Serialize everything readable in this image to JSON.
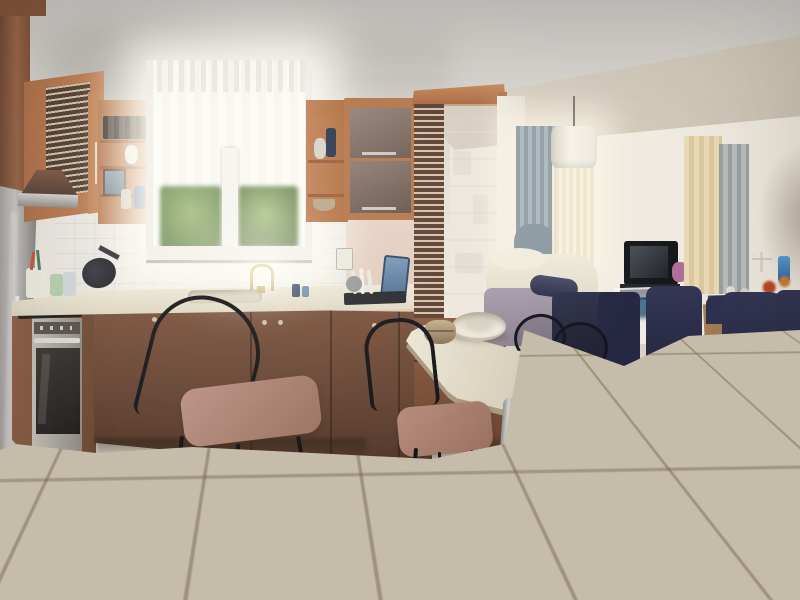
{
  "scene": {
    "domain": "natural-image",
    "description": "Panoramic daytime photo of an open-plan apartment: a kitchen with terracotta-orange cabinets, a bright curtained window and a tall glass display cabinet on the left; a small cream dining table with black metal chairs and mauve cushions in the center; a living room with a cream corner sofa, CRT television, glass coffee table, fireplace and a wooden dining table with navy upholstered chairs on the right; beige ceramic tile floor throughout.",
    "areas": [
      {
        "name": "kitchen",
        "position": "left"
      },
      {
        "name": "dining-area",
        "position": "center"
      },
      {
        "name": "living-room",
        "position": "right"
      }
    ]
  },
  "labels": {
    "stage": "Open-plan apartment interior photo",
    "ceiling": "Ceiling with diagonal soffit beam",
    "soffit": "Beige soffit beam across ceiling",
    "tall_cabinet": "Tall brown cabinet side panel",
    "fridge": "Stainless steel refrigerator",
    "upper_cabinets": "Terracotta upper cabinets with louvered door",
    "range_hood": "Copper range hood with steel rim",
    "open_shelf_left": "Open shelf unit with bottles, figurine and picture frame",
    "kitchen_window": "Kitchen window with white sheer curtain",
    "greenery": "Garden foliage seen through lower window panes",
    "open_shelf_right": "Open shelf column with bottle, figurine and bowl",
    "wall_cabinet": "Wall cabinet with two taupe lift-up doors",
    "glass_cabinet": "Tall glass-front display cabinet with glassware",
    "glassware": "Glassware on display shelves",
    "counter": "Cream laminate countertop",
    "sink": "Inset kitchen sink",
    "faucet": "Brass gooseneck faucet",
    "utensils": "Utensil cup and drinking glasses",
    "pan": "Dark frying pan on counter",
    "switch": "Light switch on backsplash",
    "cutting_board": "Blue cutting board",
    "dish_rack": "Dish drying rack with plates and pot",
    "lower_cabinets": "Dark brown base cabinets",
    "oven": "Built-in stainless oven",
    "cooktop": "Black cooktop edge",
    "floor": "Beige ceramic tile floor",
    "dining_table": "Cream laminate dining table",
    "table_leg": "Brushed metal table leg",
    "bowl": "Ceramic serving bowl on table",
    "basket": "Bread basket on table",
    "black_chair": "Black metal chair with mauve cushion",
    "wire_chairs": "Wire-back metal chairs behind table",
    "living_window": "Living room window with curtains",
    "curtain_gray": "Gray-blue curtain panel",
    "curtain_sheer": "Cream sheer curtain",
    "pendant_lamp": "White drum pendant lamp",
    "sofa": "Cream corner sofa with gray base",
    "bolster": "Navy bolster cushion",
    "dark_section": "Dark navy chaise/ottoman section",
    "tv": "CRT television on dark stand",
    "coffee_table": "Glass coffee table with items beneath",
    "curtain_beige": "Beige curtain panel",
    "arch": "Arched wall niche",
    "fireplace": "Dark green marble fireplace",
    "candelabra": "Candelabra on mantel",
    "blue_vase": "Blue vase on mantel",
    "wood_table": "Wooden dining table",
    "floral": "Red-orange flower arrangement",
    "navy_chair": "Navy upholstered dining chair with wooden legs"
  },
  "palette": {
    "cabinet_orange": "#b5764a",
    "cabinet_dark_brown": "#6b4a36",
    "countertop": "#e9e2d0",
    "floor_tile": "#c6bcaa",
    "grout": "#7d6e58",
    "navy_chair": "#2b2e49",
    "sofa_cream": "#ece6d6",
    "cushion_mauve": "#b58b7b",
    "fireplace_marble": "#27322c",
    "window_light": "#fdfcf5",
    "curtain_gray": "#9aa5ab",
    "curtain_beige": "#e7dcbd",
    "wood": "#9a7850",
    "steel": "#b8b6b2",
    "wall": "#ece7de",
    "ceiling": "#d6d2cd"
  }
}
